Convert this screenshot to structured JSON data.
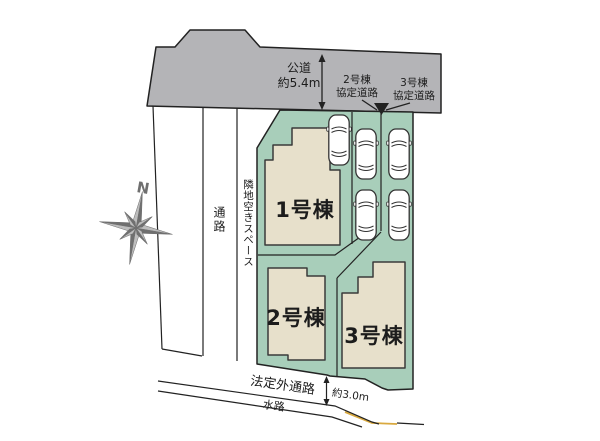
{
  "plan": {
    "title_hint": "site plan",
    "road": {
      "label_line1": "公道",
      "label_line2": "約5.4m"
    },
    "agreement_road_2": {
      "line1": "2号棟",
      "line2": "協定道路"
    },
    "agreement_road_3": {
      "line1": "3号棟",
      "line2": "協定道路"
    },
    "buildings": [
      {
        "name": "1号棟"
      },
      {
        "name": "2号棟"
      },
      {
        "name": "3号棟"
      }
    ],
    "passage_label": "通路",
    "adjacent_space_label": "隣地空きスペース",
    "non_statutory_passage_label": "法定外通路",
    "waterway_label": "水路",
    "width_label": "約3.0m",
    "compass_n": "N",
    "car_count": 5,
    "colors": {
      "road_gray": "#b4b4b7",
      "plot_green": "#a8ceba",
      "building_beige": "#e7e0cb",
      "outline": "#222222",
      "waterway_accent": "#d9a93f",
      "compass_dark": "#6f6f6f",
      "compass_light": "#bdbdbd"
    }
  }
}
